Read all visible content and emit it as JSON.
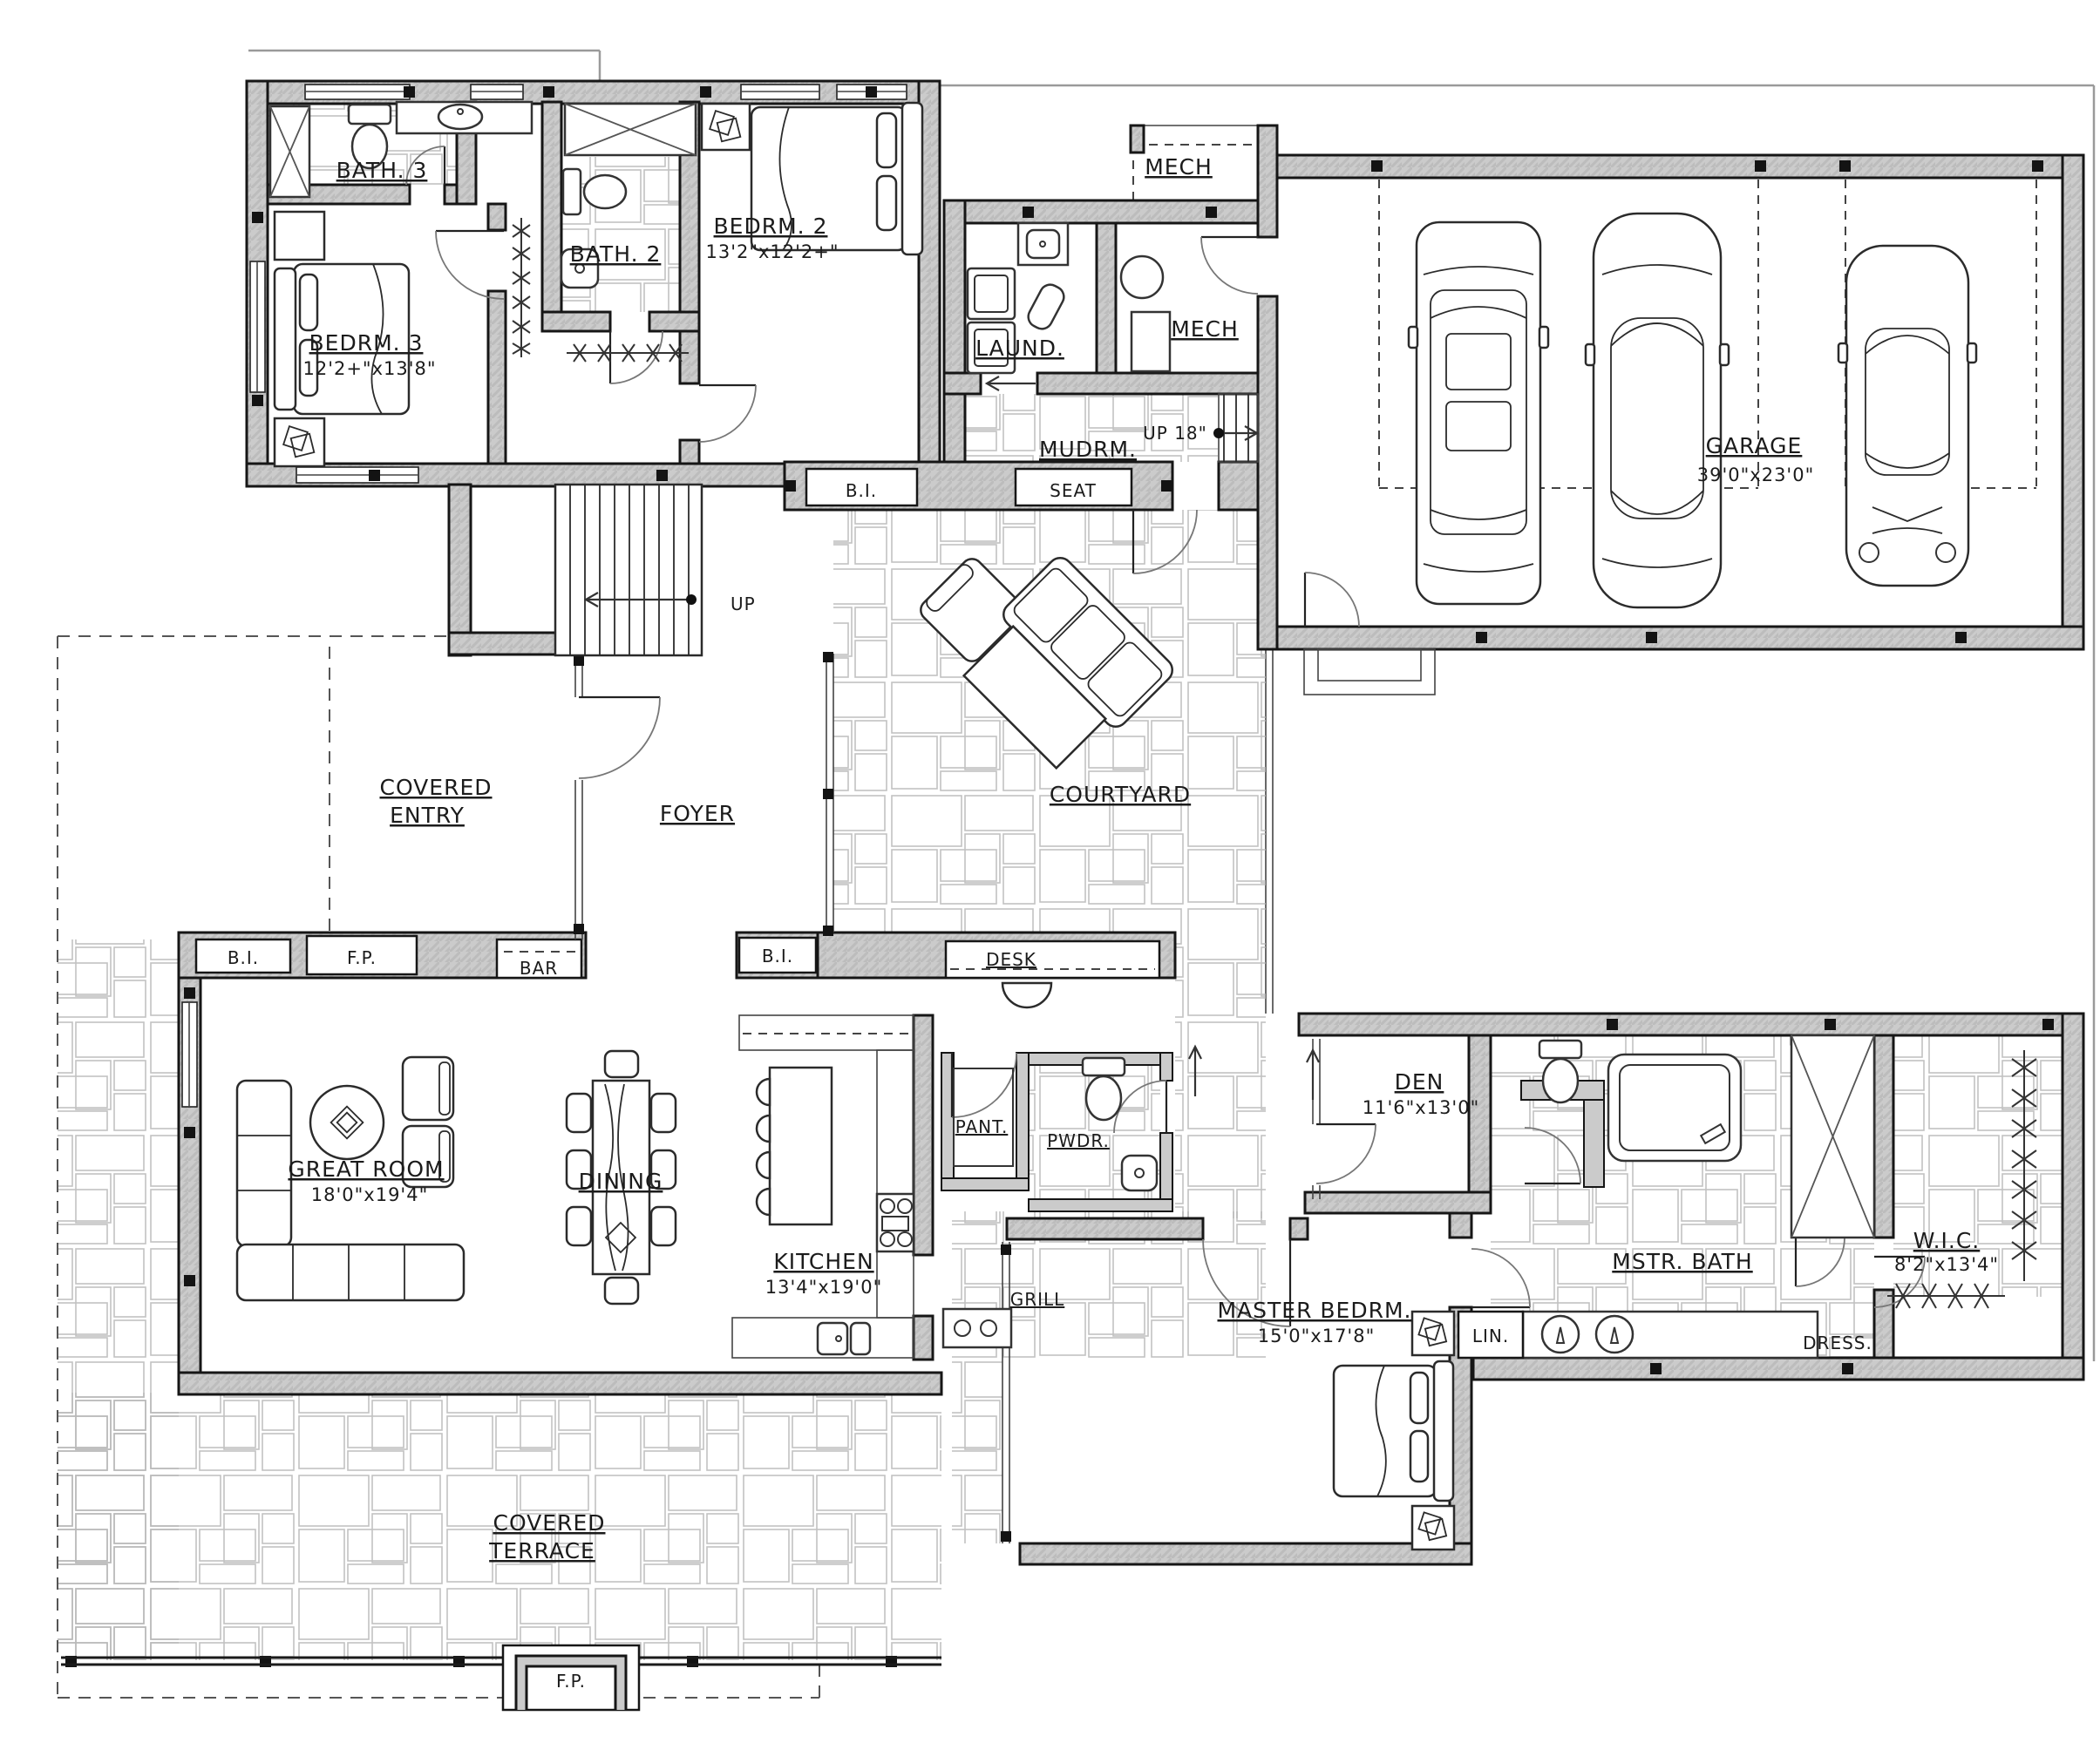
{
  "plan": {
    "type": "residential-floor-plan",
    "labels": {
      "bath3": {
        "name": "BATH. 3"
      },
      "bedrm3": {
        "name": "BEDRM. 3",
        "dims": "12'2+\"x13'8\""
      },
      "bath2": {
        "name": "BATH. 2"
      },
      "bedrm2": {
        "name": "BEDRM. 2",
        "dims": "13'2\"x12'2+\""
      },
      "mech_upper": {
        "name": "MECH"
      },
      "laundry": {
        "name": "LAUND."
      },
      "mech": {
        "name": "MECH"
      },
      "mudroom": {
        "name": "MUDRM."
      },
      "up18": {
        "name": "UP 18\""
      },
      "seat": {
        "name": "SEAT"
      },
      "bi_mudroom": {
        "name": "B.I."
      },
      "garage": {
        "name": "GARAGE",
        "dims": "39'0\"x23'0\""
      },
      "stairs_up": {
        "name": "UP"
      },
      "covered_entry": {
        "lines": [
          "COVERED",
          "ENTRY"
        ]
      },
      "foyer": {
        "name": "FOYER"
      },
      "courtyard": {
        "name": "COURTYARD"
      },
      "bi_great_room": {
        "name": "B.I."
      },
      "fireplace": {
        "name": "F.P."
      },
      "bar": {
        "name": "BAR"
      },
      "great_room": {
        "name": "GREAT ROOM",
        "dims": "18'0\"x19'4\""
      },
      "dining": {
        "name": "DINING"
      },
      "bi_kitchen": {
        "name": "B.I."
      },
      "desk": {
        "name": "DESK"
      },
      "kitchen": {
        "name": "KITCHEN",
        "dims": "13'4\"x19'0\""
      },
      "pantry": {
        "name": "PANT."
      },
      "powder": {
        "name": "PWDR."
      },
      "grill": {
        "name": "GRILL"
      },
      "den": {
        "name": "DEN",
        "dims": "11'6\"x13'0\""
      },
      "master_bedroom": {
        "name": "MASTER BEDRM.",
        "dims": "15'0\"x17'8\""
      },
      "master_bath": {
        "name": "MSTR. BATH"
      },
      "linen": {
        "name": "LIN."
      },
      "wic": {
        "name": "W.I.C.",
        "dims": "8'2\"x13'4\""
      },
      "dress": {
        "name": "DRESS."
      },
      "covered_terrace": {
        "lines": [
          "COVERED",
          "TERRACE"
        ]
      },
      "terrace_fireplace": {
        "name": "F.P."
      }
    },
    "colors": {
      "background": "#ffffff",
      "wall_fill": "#cbcbcb",
      "wall_stroke": "#161616",
      "stone_line": "#b6b6b6",
      "text": "#1b1b1b"
    }
  }
}
